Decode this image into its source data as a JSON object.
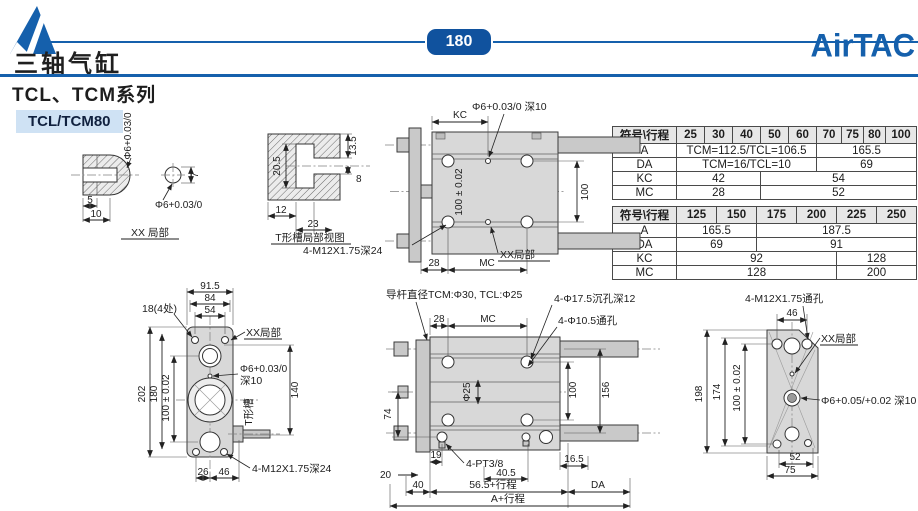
{
  "colors": {
    "brand_blue": "#1560ac",
    "badge_bg": "#10529e",
    "model_badge_bg": "#cfe2f4",
    "title_text": "#1f1f1f"
  },
  "page": {
    "number": "180"
  },
  "header": {
    "doc_title": "三轴气缸",
    "brand": "AirTAC",
    "series_title": "TCL、TCM系列"
  },
  "model_label": "TCL/TCM80",
  "tables": [
    {
      "header": [
        "符号\\行程",
        "25",
        "30",
        "40",
        "50",
        "60",
        "70",
        "75",
        "80",
        "100"
      ],
      "rows": [
        {
          "label": "A",
          "cells": [
            {
              "text": "TCM=112.5/TCL=106.5",
              "span": 5
            },
            {
              "text": "165.5",
              "span": 4
            }
          ]
        },
        {
          "label": "DA",
          "cells": [
            {
              "text": "TCM=16/TCL=10",
              "span": 5
            },
            {
              "text": "69",
              "span": 4
            }
          ]
        },
        {
          "label": "KC",
          "cells": [
            {
              "text": "42",
              "span": 3
            },
            {
              "text": "54",
              "span": 6
            }
          ]
        },
        {
          "label": "MC",
          "cells": [
            {
              "text": "28",
              "span": 3
            },
            {
              "text": "52",
              "span": 6
            }
          ]
        }
      ]
    },
    {
      "header": [
        "符号\\行程",
        "125",
        "150",
        "175",
        "200",
        "225",
        "250"
      ],
      "rows": [
        {
          "label": "A",
          "cells": [
            {
              "text": "165.5",
              "span": 2
            },
            {
              "text": "187.5",
              "span": 4
            }
          ]
        },
        {
          "label": "DA",
          "cells": [
            {
              "text": "69",
              "span": 2
            },
            {
              "text": "91",
              "span": 4
            }
          ]
        },
        {
          "label": "KC",
          "cells": [
            {
              "text": "92",
              "span": 4
            },
            {
              "text": "128",
              "span": 2
            }
          ]
        },
        {
          "label": "MC",
          "cells": [
            {
              "text": "128",
              "span": 4
            },
            {
              "text": "200",
              "span": 2
            }
          ]
        }
      ]
    }
  ],
  "drawings": {
    "xx_detail": {
      "caption": "XX 局部",
      "dia_vertical": "Φ6+0.03/0",
      "dia_circle": "Φ6+0.03/0",
      "dim_5": "5",
      "dim_10": "10",
      "dim_7": "7"
    },
    "t_slot": {
      "caption": "T形槽局部视图",
      "dim_20_5": "20.5",
      "dim_13_5": "13.5",
      "dim_8": "8",
      "dim_12": "12",
      "dim_23": "23"
    },
    "top_view": {
      "dim_kc": "KC",
      "hole_note": "Φ6+0.03/0 深10",
      "dim_100_tol": "100 ± 0.02",
      "dim_100": "100",
      "xx_label": "XX局部",
      "thread_note": "4-M12X1.75深24",
      "dim_28": "28",
      "dim_mc": "MC"
    },
    "front_view": {
      "rod_note": "导杆直径TCM:Φ30, TCL:Φ25",
      "dim_28": "28",
      "dim_mc": "MC",
      "cbore_note": "4-Φ17.5沉孔深12",
      "thru_note": "4-Φ10.5通孔",
      "dia_25": "Φ25",
      "dim_100": "100",
      "dim_156": "156",
      "dim_74": "74",
      "dim_20": "20",
      "dim_19": "19",
      "port_note": "4-PT3/8",
      "dim_40_5": "40.5",
      "dim_16_5": "16.5",
      "dim_40": "40",
      "dim_stroke": "56.5+行程",
      "dim_da": "DA",
      "dim_total": "A+行程"
    },
    "left_view": {
      "dim_91_5": "91.5",
      "dim_84": "84",
      "dim_54": "54",
      "corner_note": "18(4处)",
      "xx_label": "XX局部",
      "dim_100_tol": "100 ± 0.02",
      "dim_180": "180",
      "dim_202": "202",
      "hole_note_1": "Φ6+0.03/0",
      "hole_note_2": "深10",
      "dim_140": "140",
      "t_slot_label": "T形槽",
      "dim_26": "26",
      "dim_46": "46",
      "thread_note": "4-M12X1.75深24"
    },
    "right_view": {
      "thread_note": "4-M12X1.75通孔",
      "dim_46": "46",
      "xx_label": "XX局部",
      "dim_100_tol": "100 ± 0.02",
      "dim_174": "174",
      "dim_198": "198",
      "hole_note": "Φ6+0.05/+0.02 深10",
      "dim_52": "52",
      "dim_75": "75"
    }
  }
}
